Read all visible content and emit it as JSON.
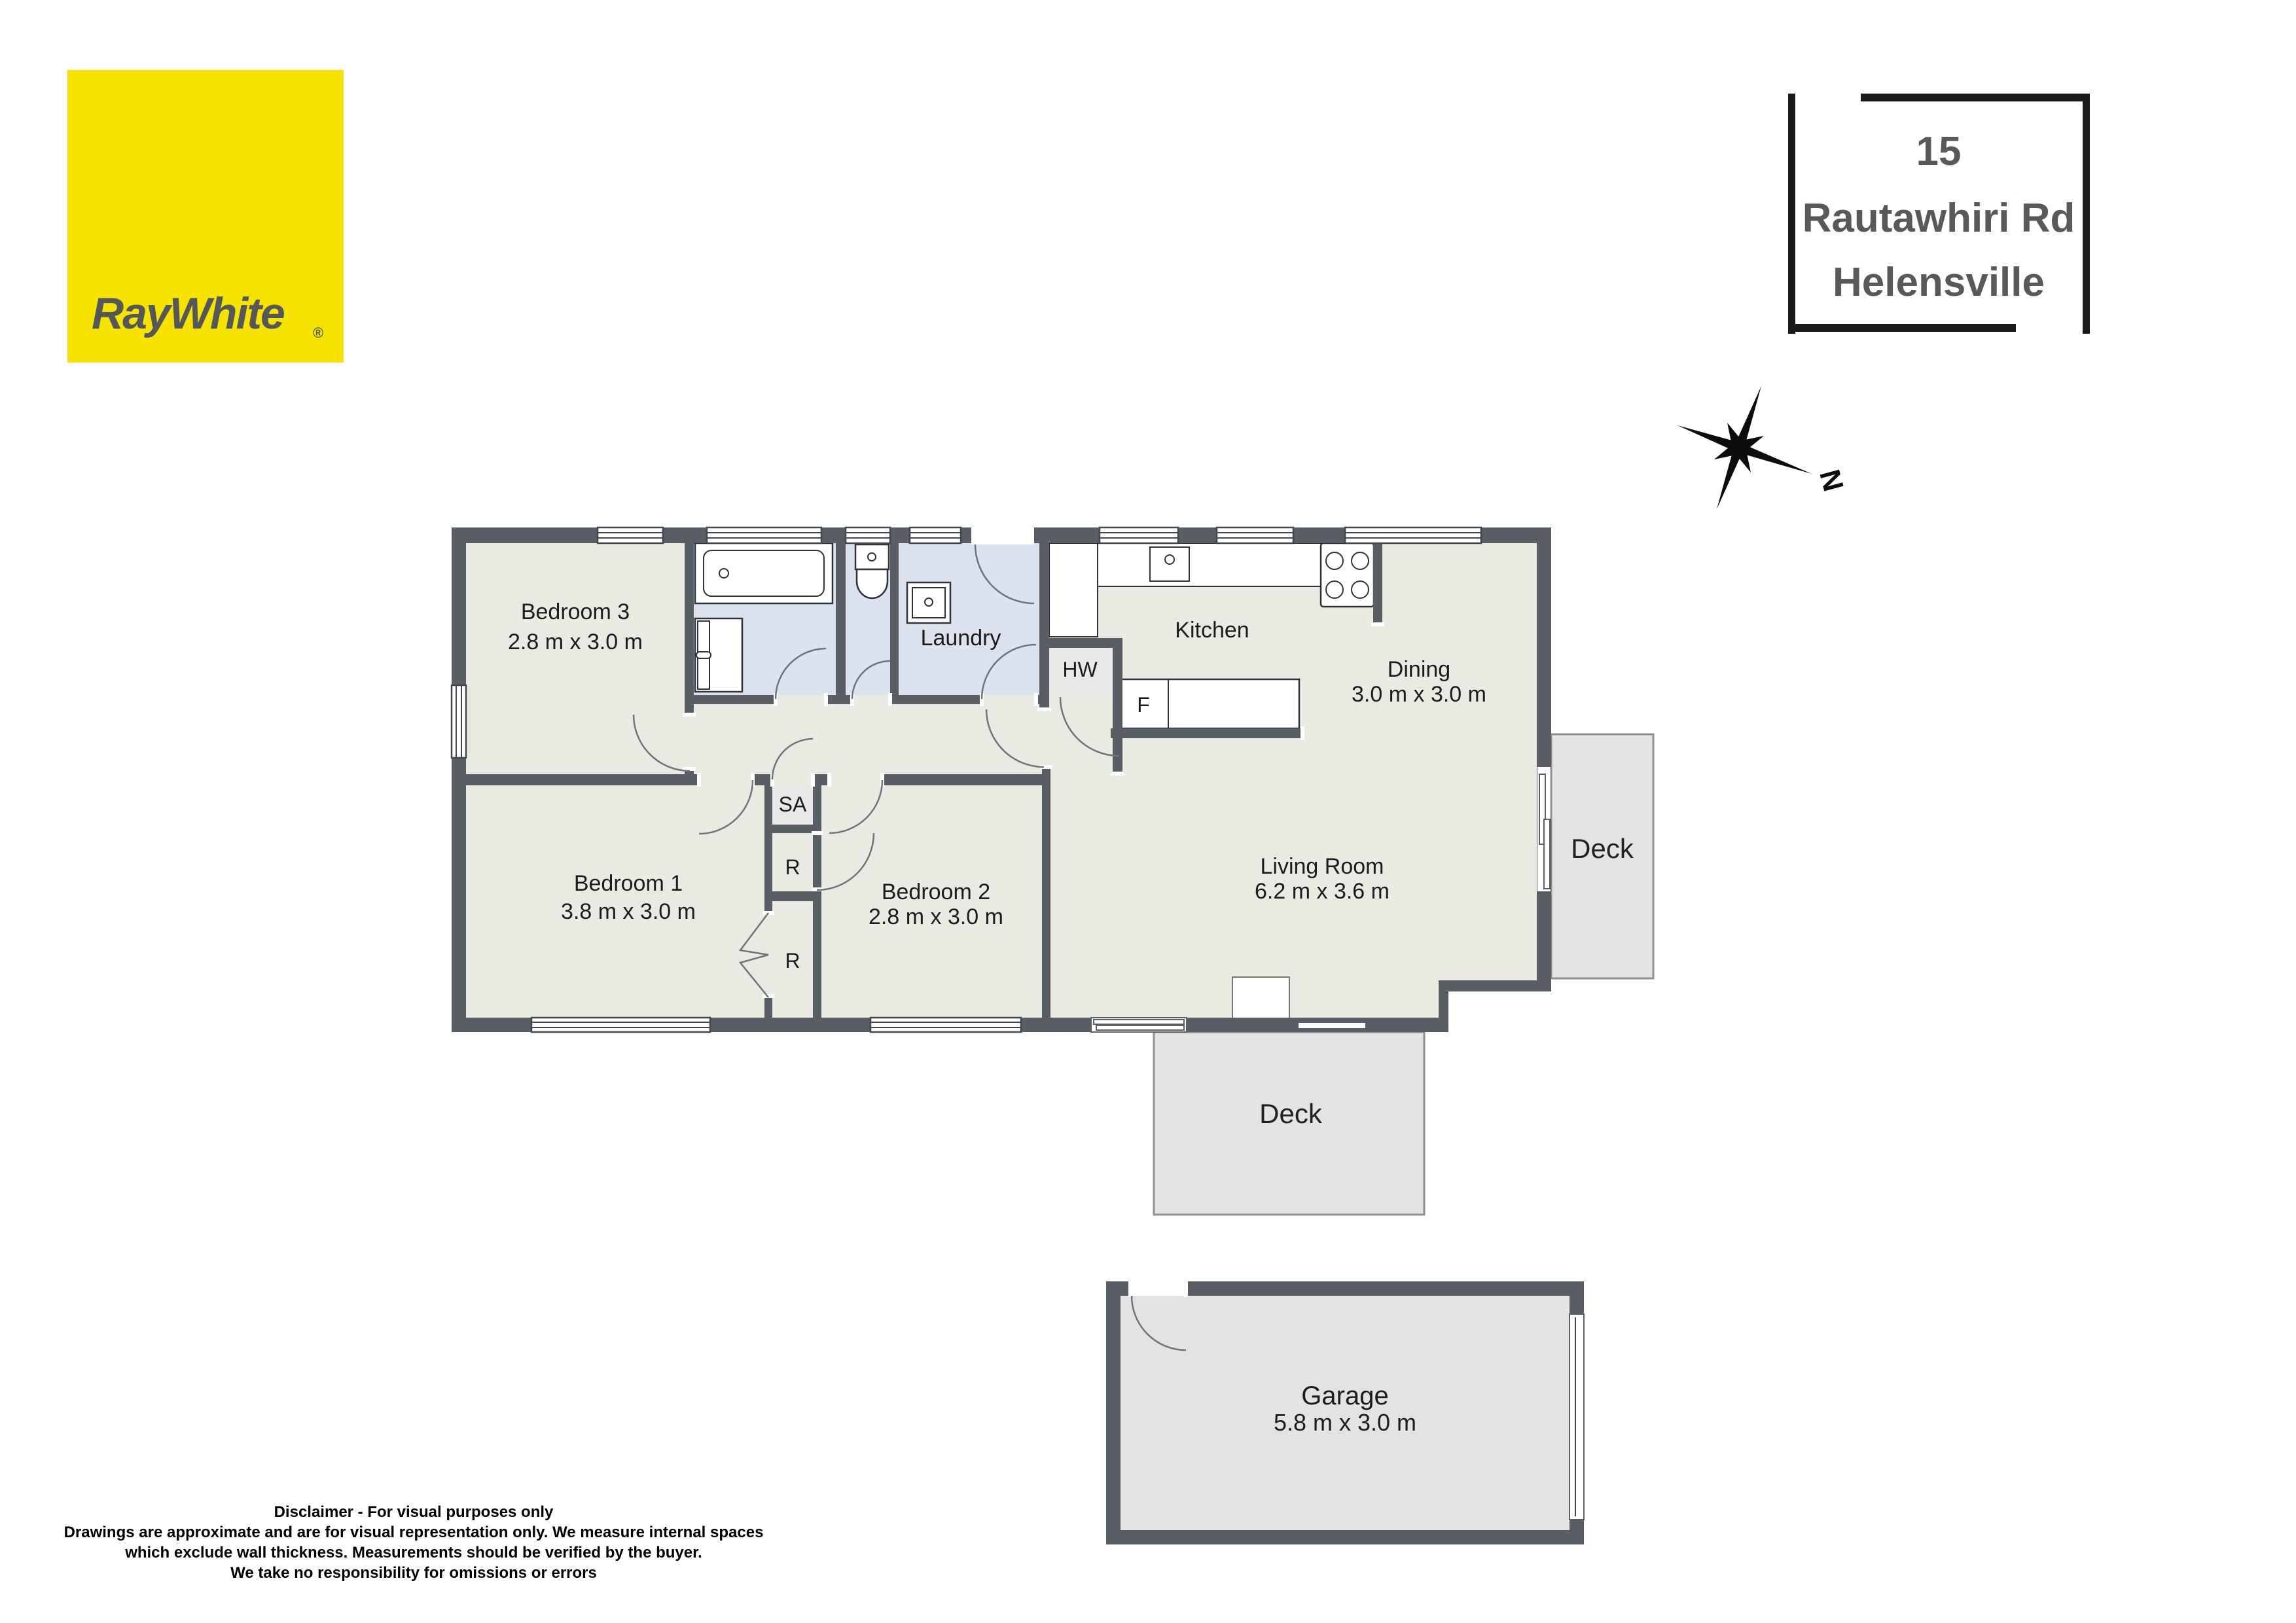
{
  "logo": {
    "brand": "RayWhite",
    "registered_mark": "®"
  },
  "address_box": {
    "line1": "15",
    "line2": "Rautawhiri Rd",
    "line3": "Helensville"
  },
  "compass": {
    "north_label": "N"
  },
  "floorplan": {
    "rooms": {
      "bedroom3": {
        "name": "Bedroom 3",
        "dims": "2.8 m x 3.0 m"
      },
      "bedroom1": {
        "name": "Bedroom 1",
        "dims": "3.8 m x 3.0 m"
      },
      "bedroom2": {
        "name": "Bedroom 2",
        "dims": "2.8 m x 3.0 m"
      },
      "laundry": {
        "name": "Laundry"
      },
      "kitchen": {
        "name": "Kitchen"
      },
      "dining": {
        "name": "Dining",
        "dims": "3.0 m x 3.0 m"
      },
      "living": {
        "name": "Living Room",
        "dims": "6.2 m x 3.6 m"
      },
      "deck_right": {
        "name": "Deck"
      },
      "deck_bottom": {
        "name": "Deck"
      },
      "garage": {
        "name": "Garage",
        "dims": "5.8 m x 3.0 m"
      }
    },
    "labels": {
      "hot_water": "HW",
      "fridge": "F",
      "storage": "SA",
      "robe_upper": "R",
      "robe_lower": "R"
    }
  },
  "disclaimer": {
    "line1": "Disclaimer - For visual purposes only",
    "line2": "Drawings are approximate and are for visual representation only. We measure internal spaces",
    "line3": "which exclude wall thickness. Measurements should be verified by the buyer.",
    "line4": "We take no responsibility for omissions or errors"
  },
  "colors": {
    "wall": "#585e64",
    "floor": "#e9eae1",
    "wet_floor": "#dde3ee",
    "closet_floor": "#e8e8e6",
    "deck_floor": "#e3e4e4",
    "garage_floor": "#e2e3e2",
    "accent_yellow": "#f6e400",
    "frame_black": "#1a1a1a",
    "text_gray": "#58595b"
  }
}
